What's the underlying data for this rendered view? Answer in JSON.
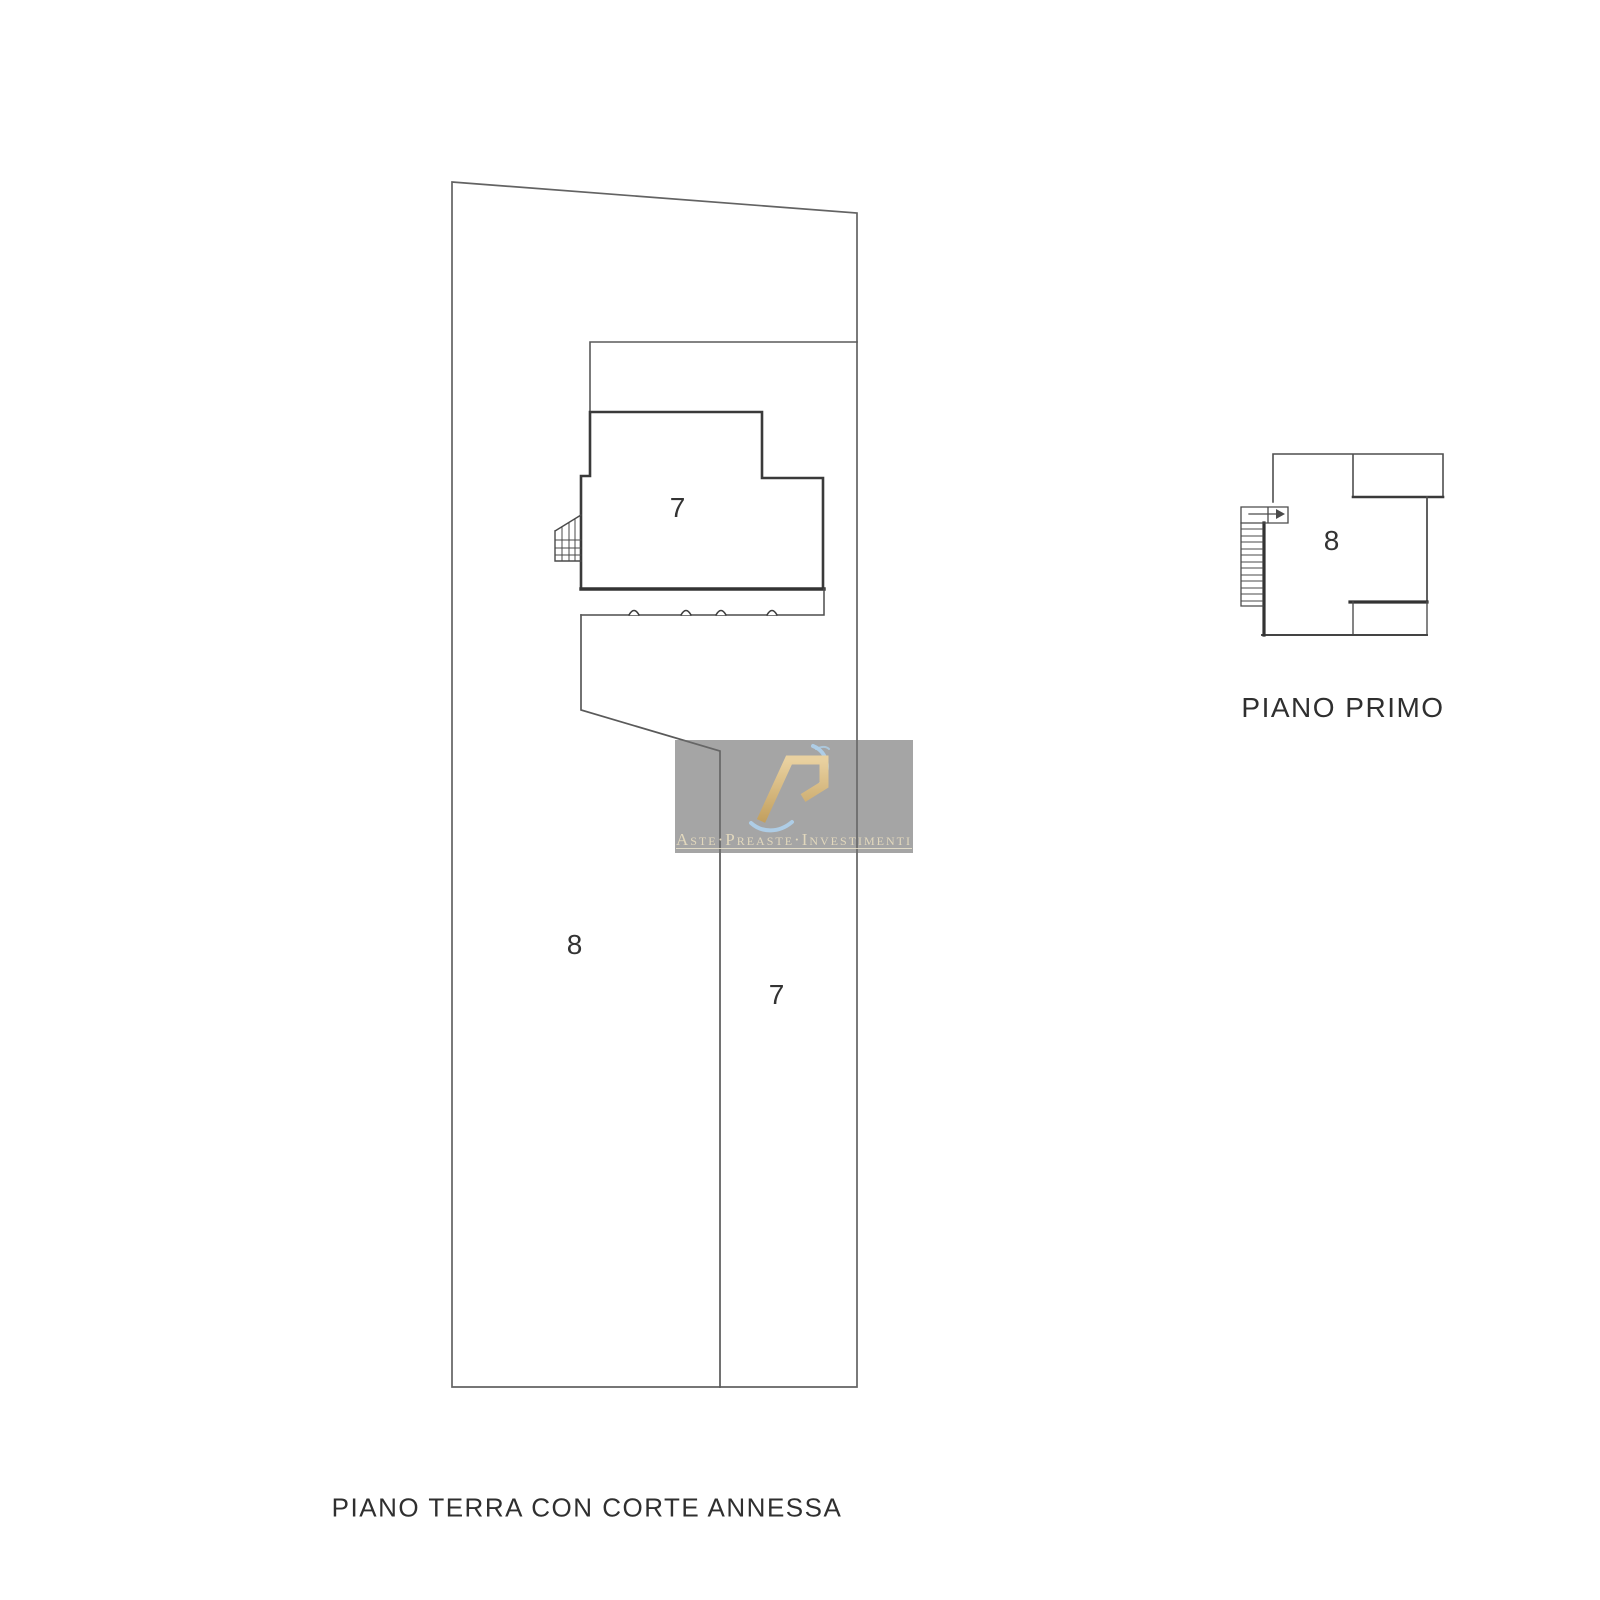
{
  "document": {
    "type_note": "cadastral floor plan sheet"
  },
  "ground_floor": {
    "caption": "PIANO TERRA CON CORTE ANNESSA",
    "building_label": "7",
    "courtyard_label": "8",
    "corridor_label": "7"
  },
  "first_floor": {
    "caption": "PIANO PRIMO",
    "room_label": "8"
  },
  "watermark": {
    "brand_text": "Aste·Preaste·Investimenti",
    "icons": {
      "brand_monogram_icon": "RA",
      "stair_direction_arrow_icon": "→"
    },
    "colors": {
      "panel": "rgba(110,110,110,0.62)",
      "gold": "#d4b376",
      "blue": "#aecfe9"
    }
  }
}
